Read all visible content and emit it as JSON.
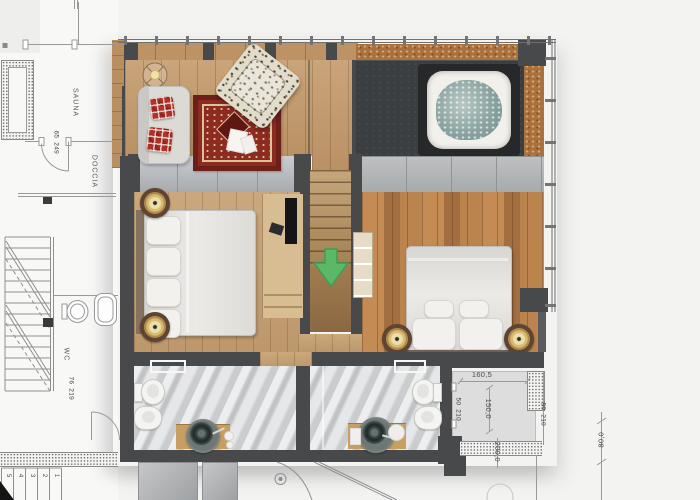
{
  "colors": {
    "wall_dark": "#47494b",
    "wood_floor_light": "#c49a6b",
    "wood_floor_rustic": "#b8834f",
    "wood_beam_osb": "#a9713d",
    "stair_wood": "#b9935f",
    "slate_platform": "#3b3e41",
    "glass_partition": "#b9bcbf",
    "wall_tile_gray": "#b5b8b9",
    "marble_floor": "#d3d4d6",
    "rug_red": "#8e2b20",
    "plaid_red": "#b03227",
    "brass_lamp": "#d9ba72",
    "jacuzzi_water": "#8aa3a0",
    "arrow_green": "#5cb869",
    "cad_line_gray": "#9a9a9b",
    "background": "#f3f3f2"
  },
  "cad": {
    "room_labels": [
      {
        "id": "sauna",
        "text": "SAUNA"
      },
      {
        "id": "doccia",
        "text": "DOCCIA"
      },
      {
        "id": "wc",
        "text": "WC"
      }
    ],
    "dimensions": {
      "sauna_door": {
        "width": "65",
        "height": "249"
      },
      "wc_door": {
        "width": "76",
        "height": "219"
      },
      "lower_right_door_a": {
        "width": "50",
        "height": "210"
      },
      "lower_right_door_b": {
        "width": "90",
        "height": "210"
      },
      "terrace_width": "160,5",
      "terrace_depth": "150,0",
      "terrace_side": "200,0",
      "walkway": "80,0"
    },
    "stair_step_numbers": [
      "5",
      "4",
      "3",
      "2",
      "1"
    ]
  },
  "plan": {
    "furniture_icons": [
      "ceiling-light-icon",
      "chaise-longue",
      "plaid-pillows",
      "oriental-rug",
      "magazines",
      "armchair",
      "staircase-down",
      "stair-down-arrow-icon",
      "glass-wardrobe",
      "jacuzzi",
      "double-bed-left",
      "double-bed-right",
      "nightstand-lamps",
      "tv-console",
      "ladder-shelf",
      "toilet",
      "bidet",
      "vanity-with-vessel-sink",
      "towel-rail",
      "shower-stalls",
      "balustrade"
    ]
  }
}
